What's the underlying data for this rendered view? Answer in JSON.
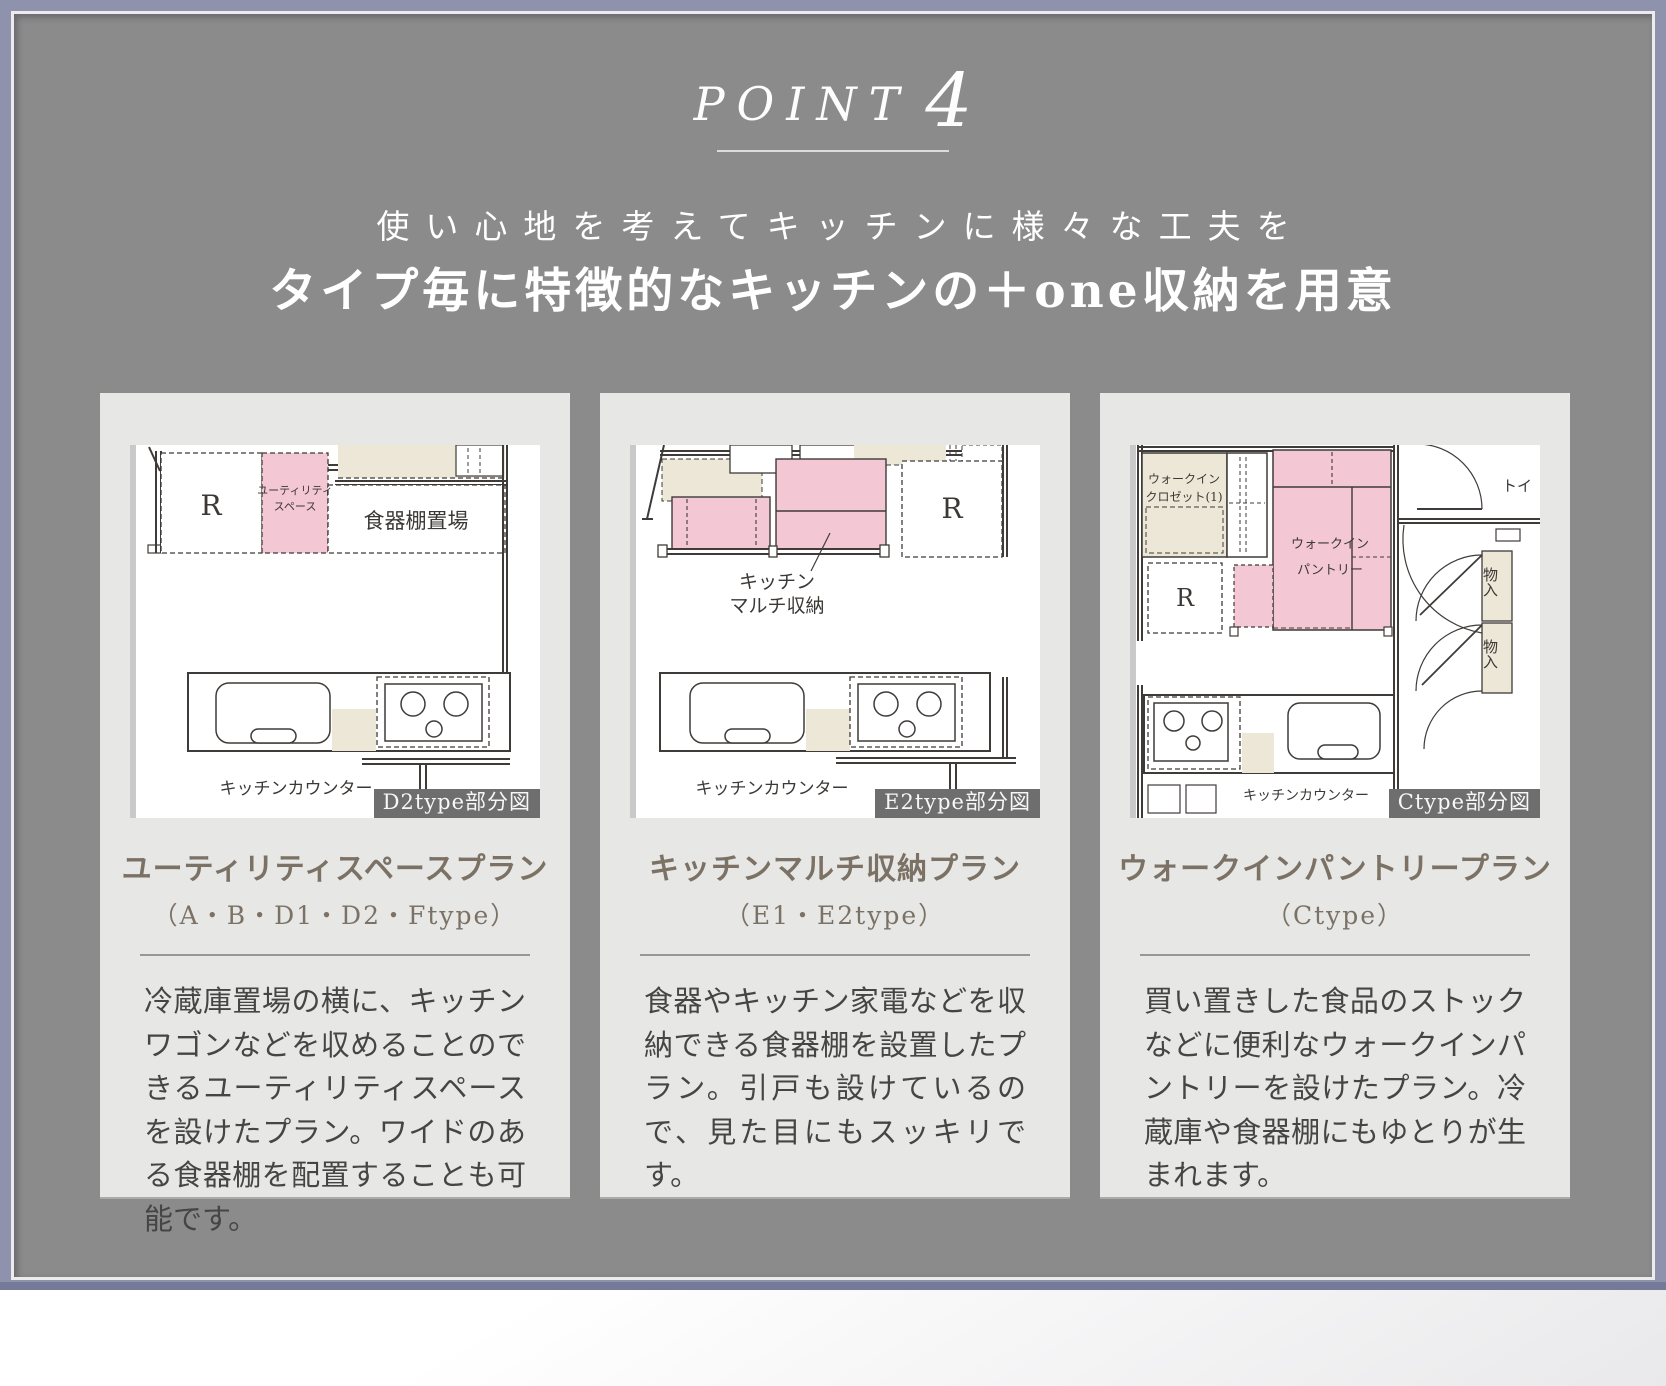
{
  "point": {
    "label": "POINT",
    "number": "4"
  },
  "heading": {
    "subtitle": "使い心地を考えてキッチンに様々な工夫を",
    "title": "タイプ毎に特徴的なキッチンの＋one収納を用意"
  },
  "colors": {
    "page_bg": "#8b8b8b",
    "frame": "#8e92ac",
    "frame_bottom": "#767a99",
    "card_bg": "#e7e7e6",
    "highlight_pink": "#f3c7d4",
    "fixture_beige": "#ece7d7",
    "title_brown": "#7b7265",
    "body_text": "#454545",
    "badge_bg": "#6e6e6e"
  },
  "cards": [
    {
      "badge": "D2type部分図",
      "title": "ユーティリティスペースプラン",
      "types": "（A・B・D1・D2・Ftype）",
      "body": "冷蔵庫置場の横に、キッチンワゴンなどを収めることのできるユーティリティスペースを設けたプラン。ワイドのある食器棚を配置することも可能です。",
      "plan": {
        "fridge": "R",
        "utility_line1": "ユーティリティ",
        "utility_line2": "スペース",
        "shelf_label": "食器棚置場",
        "counter_label": "キッチンカウンター"
      }
    },
    {
      "badge": "E2type部分図",
      "title": "キッチンマルチ収納プラン",
      "types": "（E1・E2type）",
      "body": "食器やキッチン家電などを収納できる食器棚を設置したプラン。引戸も設けているので、見た目にもスッキリです。",
      "plan": {
        "fridge": "R",
        "multi_line1": "キッチン",
        "multi_line2": "マルチ収納",
        "counter_label": "キッチンカウンター"
      }
    },
    {
      "badge": "Ctype部分図",
      "title": "ウォークインパントリープラン",
      "types": "（Ctype）",
      "body": "買い置きした食品のストックなどに便利なウォークインパントリーを設けたプラン。冷蔵庫や食器棚にもゆとりが生まれます。",
      "plan": {
        "closet_line1": "ウォークイン",
        "closet_line2": "クロゼット(1)",
        "pantry_line1": "ウォークイン",
        "pantry_line2": "パントリー",
        "fridge": "R",
        "toilet_label": "トイ",
        "storage_upper": "物入",
        "storage_lower": "物入",
        "counter_label": "キッチンカウンター"
      }
    }
  ]
}
